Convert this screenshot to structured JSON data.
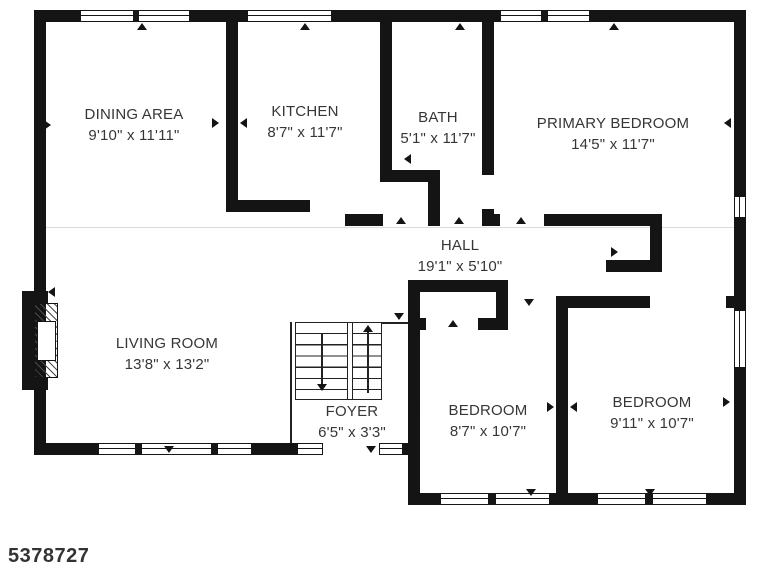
{
  "listing_id": "5378727",
  "rooms": [
    {
      "name": "DINING AREA",
      "dims": "9'10\" x 11'11\""
    },
    {
      "name": "KITCHEN",
      "dims": "8'7\" x 11'7\""
    },
    {
      "name": "BATH",
      "dims": "5'1\" x 11'7\""
    },
    {
      "name": "PRIMARY BEDROOM",
      "dims": "14'5\" x 11'7\""
    },
    {
      "name": "HALL",
      "dims": "19'1\" x 5'10\""
    },
    {
      "name": "LIVING ROOM",
      "dims": "13'8\" x 13'2\""
    },
    {
      "name": "FOYER",
      "dims": "6'5\" x 3'3\""
    },
    {
      "name": "BEDROOM",
      "dims": "8'7\" x 10'7\""
    },
    {
      "name": "BEDROOM",
      "dims": "9'11\" x 10'7\""
    }
  ],
  "colors": {
    "wall": "#141414",
    "text": "#363636",
    "background": "#ffffff"
  }
}
